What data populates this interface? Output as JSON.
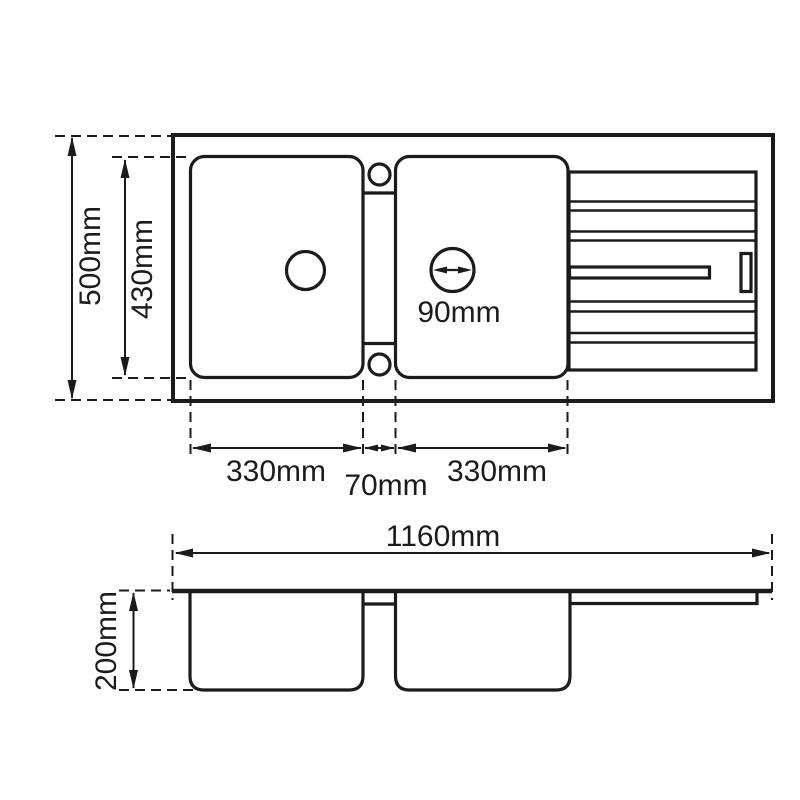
{
  "background_color": "#ffffff",
  "line_color": "#1b1b1b",
  "unit": "mm",
  "top_view": {
    "overall_depth_label": "500mm",
    "inner_depth_label": "430mm",
    "left_bowl_width_label": "330mm",
    "gap_width_label": "70mm",
    "right_bowl_width_label": "330mm",
    "drain_diameter_label": "90mm"
  },
  "side_view": {
    "overall_width_label": "1160mm",
    "bowl_height_label": "200mm"
  }
}
